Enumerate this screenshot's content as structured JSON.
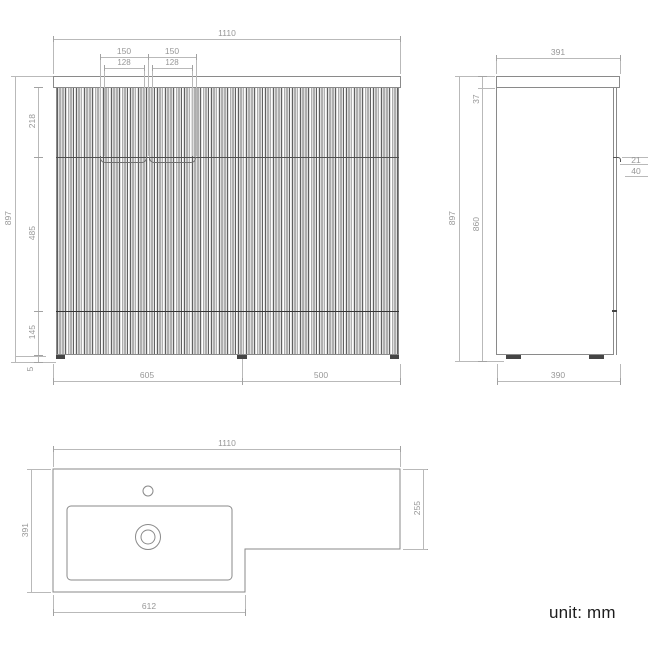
{
  "unit_note": "unit: mm",
  "colors": {
    "outline": "#8a8a8a",
    "dimension_line": "#b9b9b9",
    "dimension_text": "#979797",
    "dark_line": "#3a3a3a",
    "background": "#ffffff"
  },
  "front_view": {
    "width_total": "1110",
    "handle_span_left": "150",
    "handle_span_right": "150",
    "handle_inner_left": "128",
    "handle_inner_right": "128",
    "height_total": "897",
    "drawer_height": "218",
    "door_height": "485",
    "plinth_height": "145",
    "foot_height": "5",
    "vanity_width": "605",
    "wc_width": "500"
  },
  "side_view": {
    "depth_top": "391",
    "counter_thickness": "37",
    "height_total": "897",
    "cabinet_height": "860",
    "handle_reveal": "21",
    "handle_depth": "40",
    "depth_base": "390"
  },
  "plan_view": {
    "width_total": "1110",
    "depth_left": "391",
    "depth_right": "255",
    "basin_width": "612"
  }
}
